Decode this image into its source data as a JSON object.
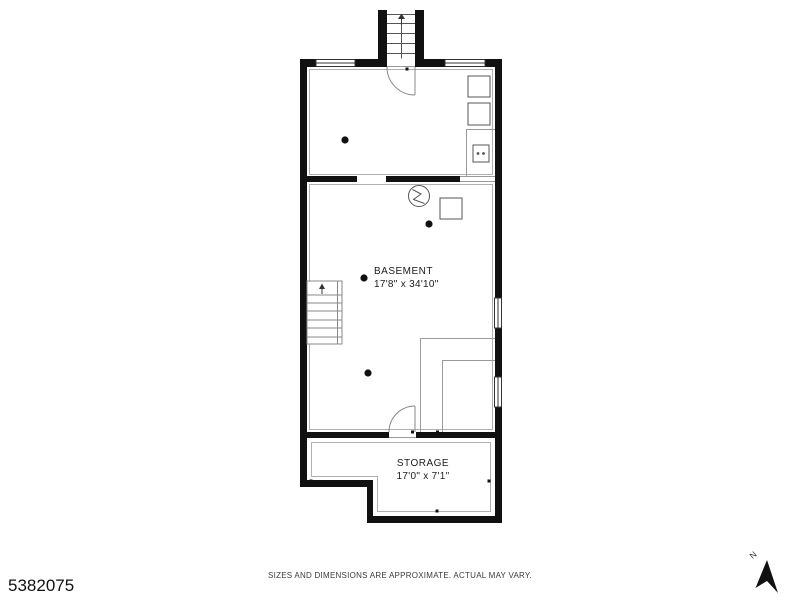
{
  "floorplan": {
    "title": "basement-floor-plan",
    "rooms": {
      "basement": {
        "name": "BASEMENT",
        "dimensions": "17'8\" x 34'10\""
      },
      "storage": {
        "name": "STORAGE",
        "dimensions": "17'0\" x 7'1\""
      }
    }
  },
  "footer": {
    "listing_id": "5382075",
    "disclaimer": "SIZES AND DIMENSIONS ARE APPROXIMATE. ACTUAL MAY VARY."
  },
  "compass": {
    "label": "N"
  },
  "colors": {
    "wall": "#111111",
    "detail_line": "#555555",
    "light_line": "#9a9a9a",
    "inner_outline": "#b0b0b0",
    "text": "#1c1c1c"
  }
}
